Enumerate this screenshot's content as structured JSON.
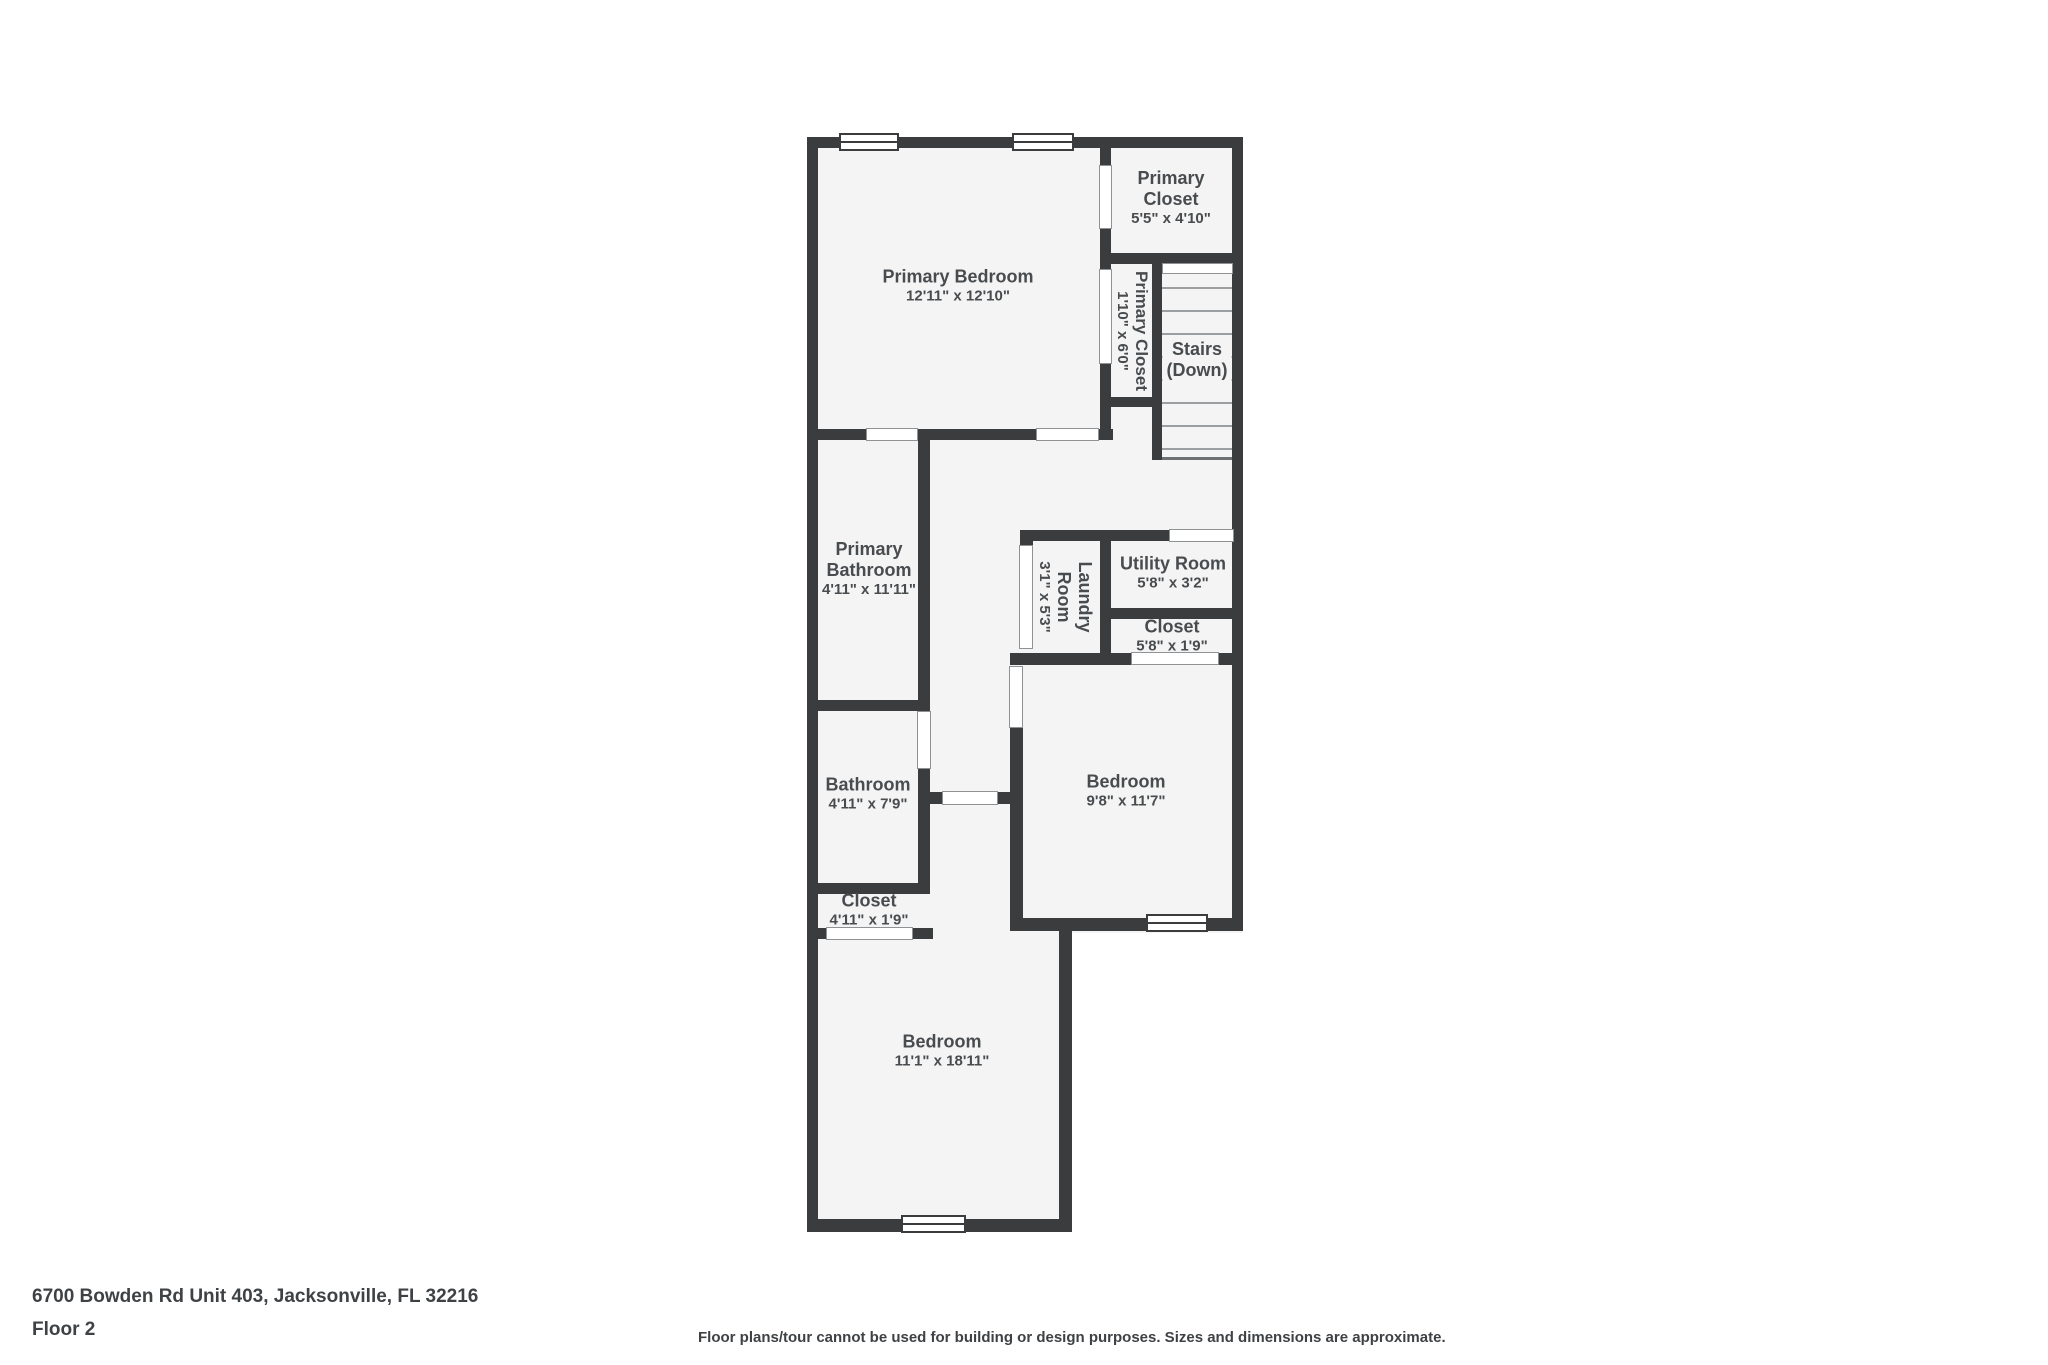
{
  "floor_plan": {
    "rooms": [
      {
        "name": "Primary Bedroom",
        "dims": "12'11\" x 12'10\""
      },
      {
        "name": "Primary Closet",
        "dims": "5'5\" x 4'10\""
      },
      {
        "name": "Primary Closet",
        "dims": "1'10\" x 6'0\"",
        "orientation": "vertical"
      },
      {
        "name": "Stairs",
        "dims": "(Down)"
      },
      {
        "name": "Primary Bathroom",
        "dims": "4'11\" x 11'11\""
      },
      {
        "name": "Laundry Room",
        "dims": "3'1\" x 5'3\"",
        "orientation": "vertical"
      },
      {
        "name": "Utility Room",
        "dims": "5'8\" x 3'2\""
      },
      {
        "name": "Closet",
        "dims": "5'8\" x 1'9\""
      },
      {
        "name": "Bedroom",
        "dims": "9'8\" x 11'7\""
      },
      {
        "name": "Bathroom",
        "dims": "4'11\" x 7'9\""
      },
      {
        "name": "Closet",
        "dims": "4'11\" x 1'9\""
      },
      {
        "name": "Bedroom",
        "dims": "11'1\" x 18'11\""
      }
    ],
    "colors": {
      "wall": "#3a3c3e",
      "floor": "#f4f4f4",
      "label_text": "#494c4f",
      "stair_tread": "#9b9fa2",
      "door_outline": "#8f9295"
    }
  },
  "footer": {
    "address": "6700 Bowden Rd Unit 403, Jacksonville, FL 32216",
    "floor_label": "Floor 2",
    "disclaimer": "Floor plans/tour cannot be used for building or design purposes. Sizes and dimensions are approximate."
  }
}
